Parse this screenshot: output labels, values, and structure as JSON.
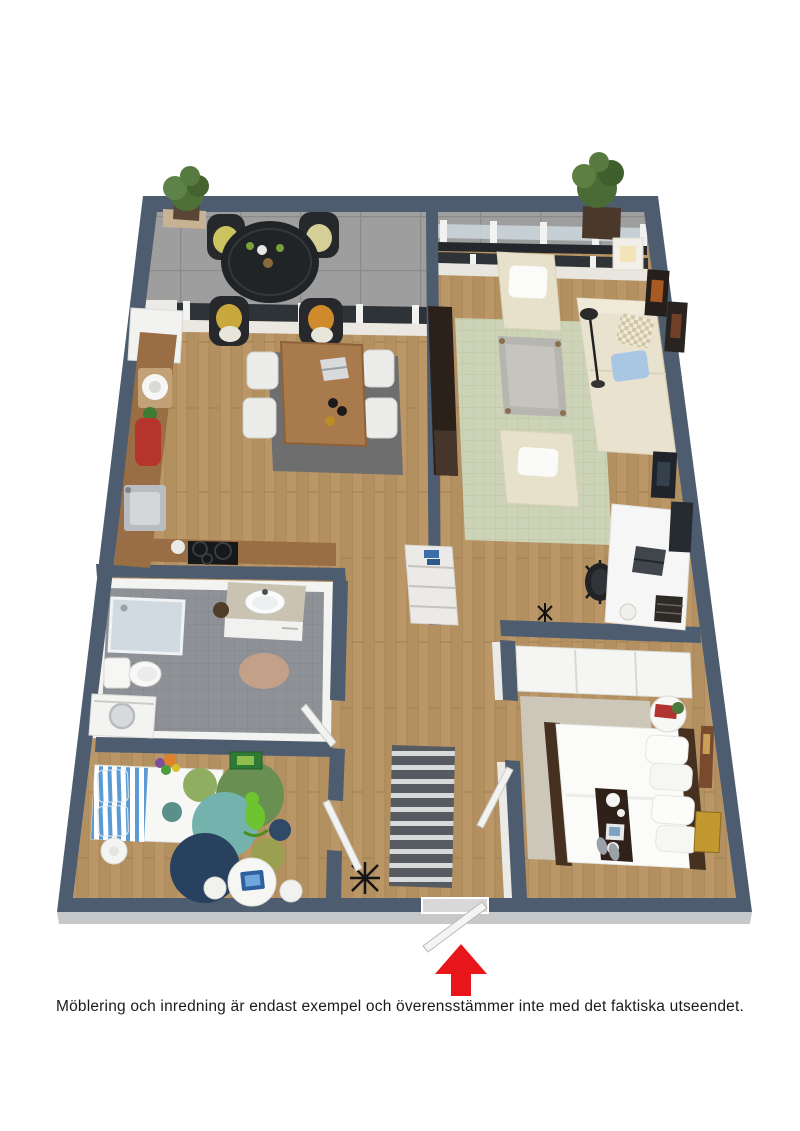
{
  "caption": {
    "text": "Möblering och inredning är endast exempel och överensstämmer inte med det faktiska utseendet."
  },
  "theme": {
    "wall": "#4d5c6e",
    "arrow": "#e8161b",
    "caption": "#1b1b1b",
    "bg": "#ffffff",
    "wood_floor": "#b39060",
    "terrace_tile": "#9e9e9e",
    "bathroom_tile": "#8e9297",
    "living_rug": "#ccd3b6",
    "dining_rug": "#6e6e6e",
    "hall_rug": "#565b61"
  },
  "plan": {
    "view": "3d-top-down-render",
    "entrance_marker": "red-arrow-up",
    "rooms": [
      {
        "name": "terrace",
        "floor": "grey-tile",
        "items": [
          "potted-plant",
          "round-table",
          "4-wicker-chairs",
          "glass-balustrade",
          "potted-plant"
        ]
      },
      {
        "name": "dining-kitchen",
        "floor": "wood",
        "items": [
          "dining-table",
          "4-white-chairs",
          "grey-rug",
          "laptop",
          "kitchen-counter",
          "sink",
          "cooktop",
          "red-canister",
          "tall-cabinet"
        ]
      },
      {
        "name": "living-room",
        "floor": "wood",
        "items": [
          "sofa",
          "chaise",
          "armchair",
          "coffee-table",
          "checkered-rug",
          "tv-sideboard",
          "desk",
          "office-chair",
          "laptop",
          "shelf-unit",
          "wall-art",
          "floor-lamp"
        ]
      },
      {
        "name": "bathroom",
        "floor": "grey-tile",
        "items": [
          "shower",
          "vanity-sink",
          "toilet",
          "washing-machine",
          "round-rug"
        ]
      },
      {
        "name": "kids-room",
        "floor": "wood",
        "items": [
          "single-bed-blue-stripes",
          "round-rugs",
          "rocking-toy",
          "play-table",
          "stools",
          "wall-art"
        ]
      },
      {
        "name": "bedroom",
        "floor": "wood",
        "items": [
          "double-bed",
          "breakfast-tray",
          "wardrobe",
          "round-side-table",
          "wall-art",
          "slippers"
        ]
      },
      {
        "name": "hallway",
        "floor": "wood",
        "items": [
          "striped-runner-rug",
          "coat-rack",
          "doors",
          "entrance-door"
        ]
      }
    ]
  }
}
